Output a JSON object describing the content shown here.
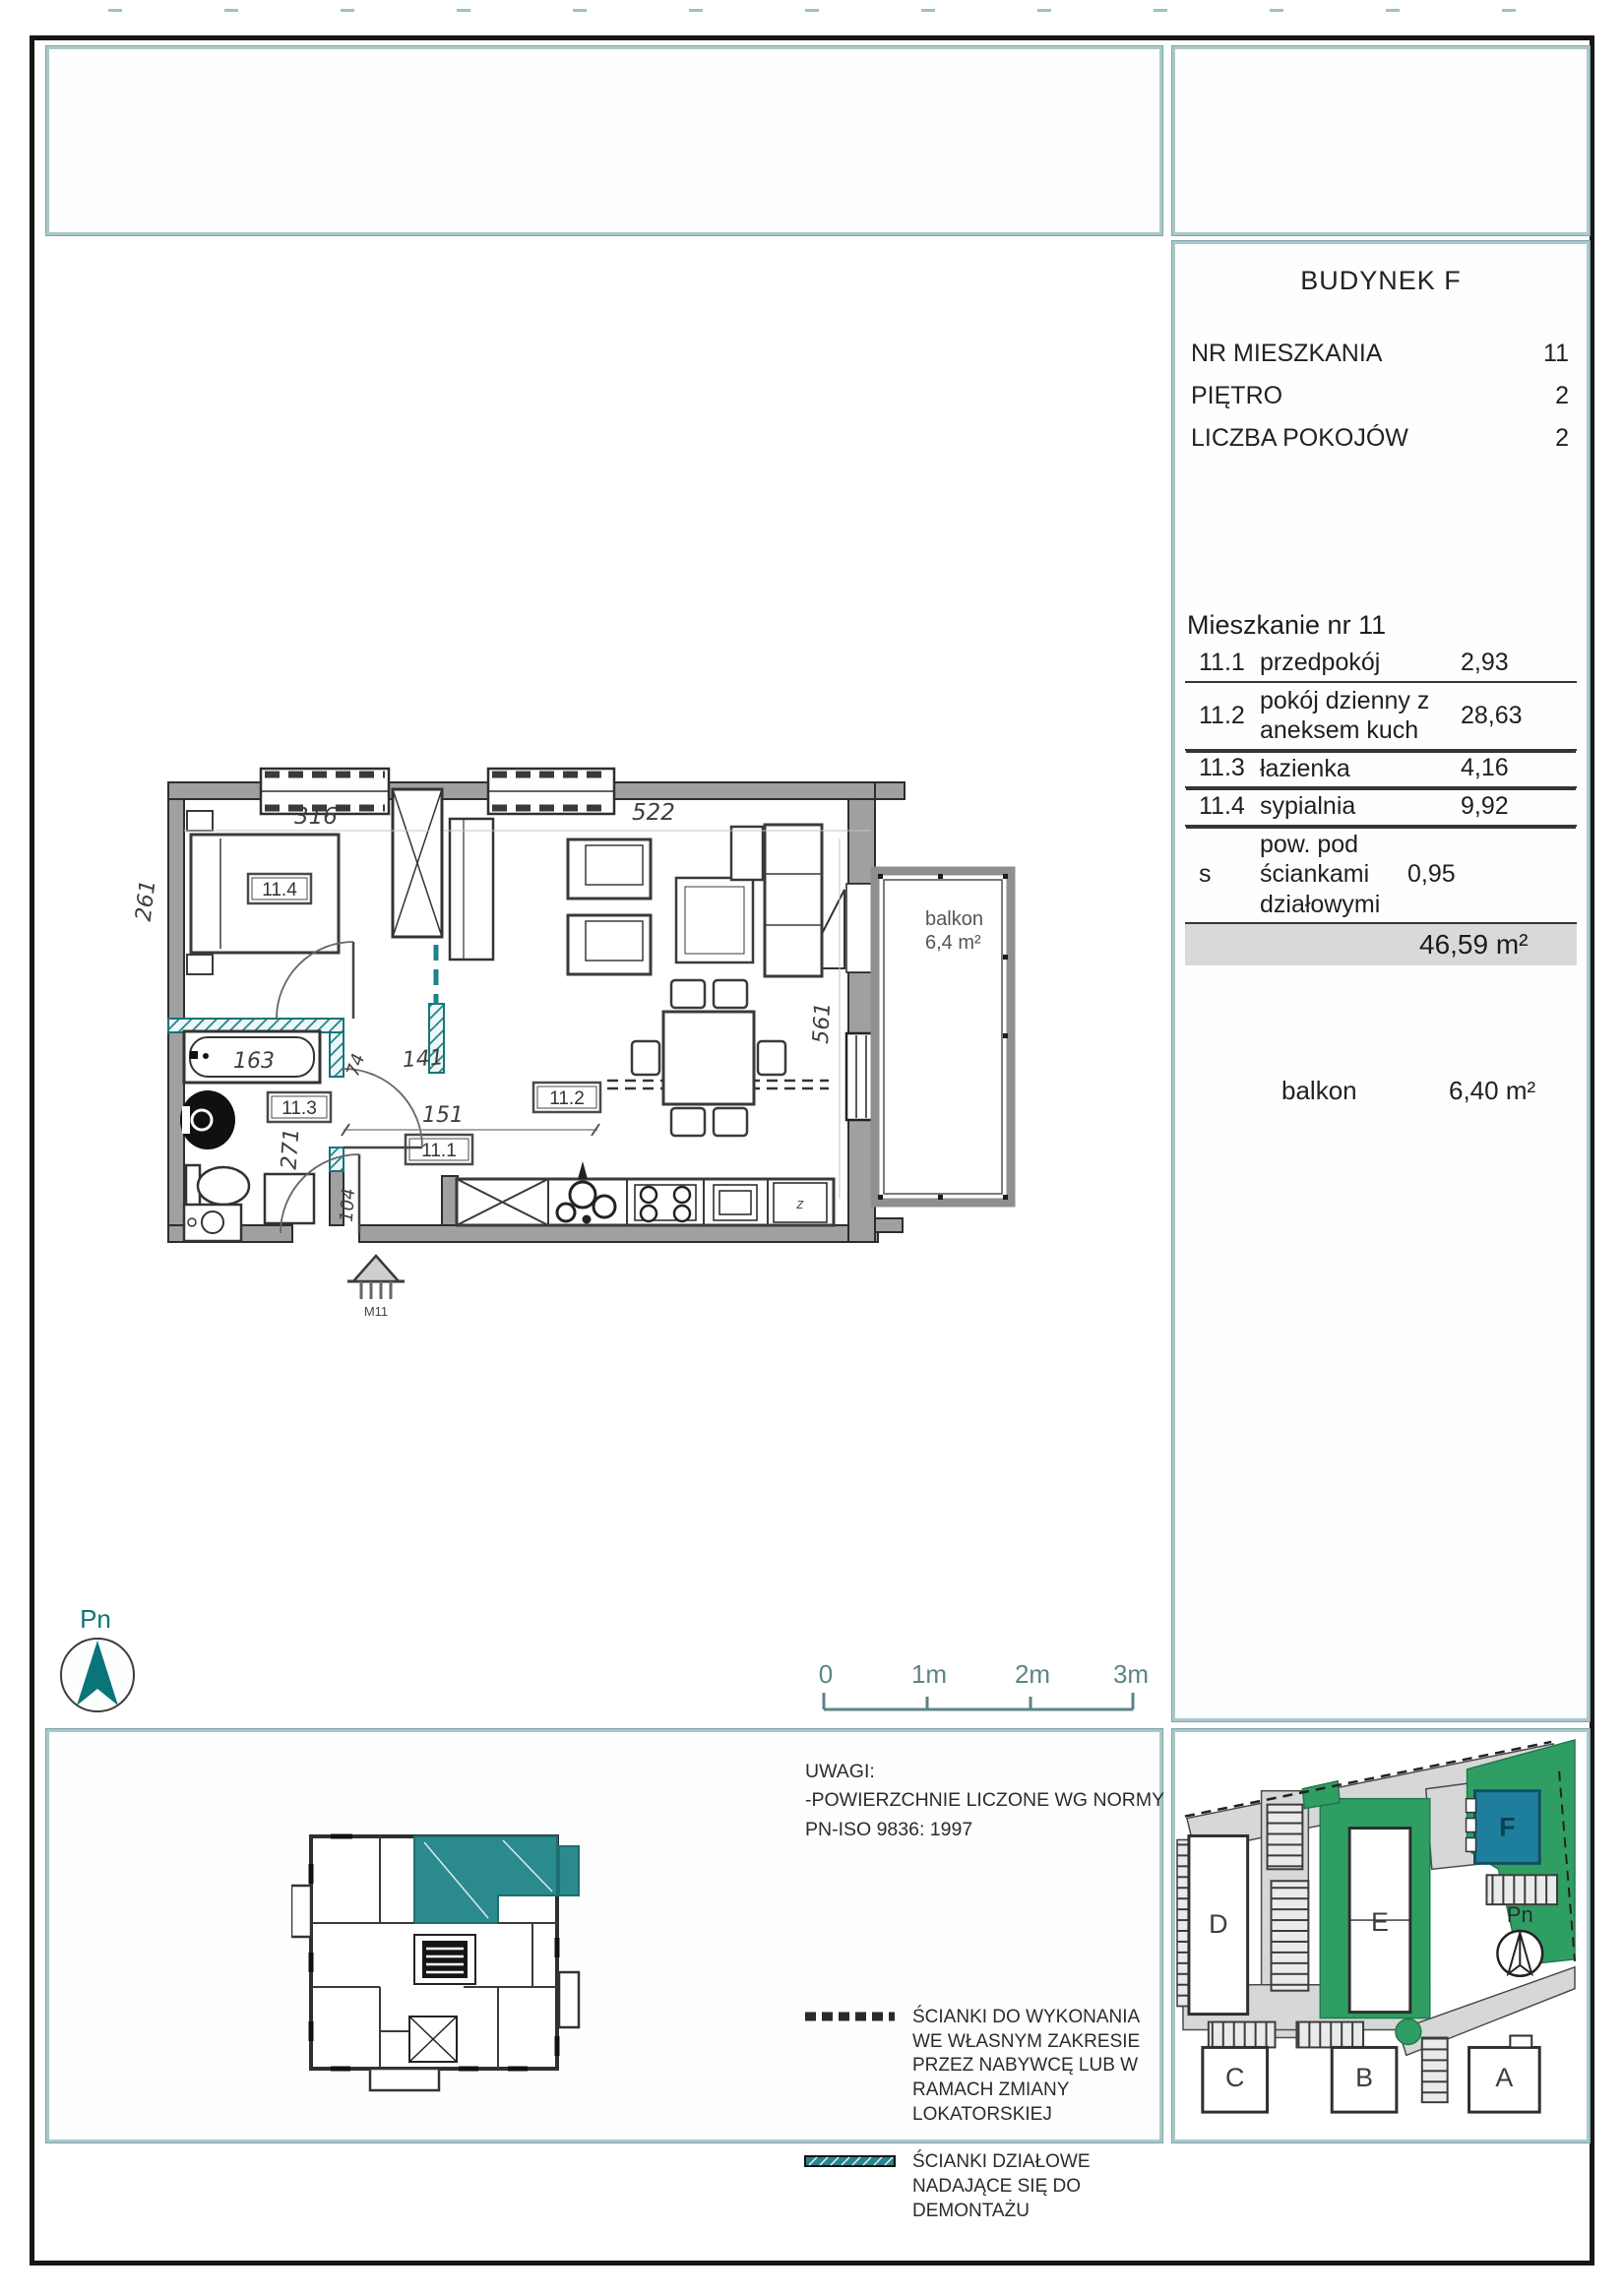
{
  "info_panel": {
    "title": "BUDYNEK F",
    "fields": [
      {
        "label": "NR MIESZKANIA",
        "value": "11"
      },
      {
        "label": "PIĘTRO",
        "value": "2"
      },
      {
        "label": "LICZBA POKOJÓW",
        "value": "2"
      }
    ],
    "apartment_heading": "Mieszkanie nr 11",
    "rooms": [
      {
        "no": "11.1",
        "name": "przedpokój",
        "area": "2,93"
      },
      {
        "no": "11.2",
        "name": "pokój dzienny z aneksem kuch",
        "area": "28,63"
      },
      {
        "no": "11.3",
        "name": "łazienka",
        "area": "4,16"
      },
      {
        "no": "11.4",
        "name": "sypialnia",
        "area": "9,92"
      },
      {
        "no": "s",
        "name": "pow. pod ściankami działowymi",
        "area": "0,95"
      }
    ],
    "total_area": "46,59 m²",
    "balcony_label": "balkon",
    "balcony_area": "6,40 m²"
  },
  "floor_plan": {
    "rooms": {
      "hall": "11.1",
      "living": "11.2",
      "bath": "11.3",
      "bedroom": "11.4"
    },
    "dims": {
      "top_left": "316",
      "top_right": "522",
      "left_side": "261",
      "right_side": "561",
      "bath_tub": "163",
      "hall_a": "74",
      "hall_b": "141",
      "hall_c": "151",
      "bath_height": "271",
      "entry": "104"
    },
    "balcony": {
      "label": "balkon",
      "area": "6,4 m²"
    },
    "entrance_label": "M11",
    "fridge_label": "z",
    "compass_label": "Pn"
  },
  "scale_bar": {
    "t0": "0",
    "t1": "1m",
    "t2": "2m",
    "t3": "3m"
  },
  "notes_panel": {
    "uwagi_line1": "UWAGI:",
    "uwagi_line2": "-POWIERZCHNIE LICZONE WG NORMY",
    "uwagi_line3": "PN-ISO 9836: 1997",
    "legend": [
      {
        "text": "ŚCIANKI DO WYKONANIA WE WŁASNYM ZAKRESIE PRZEZ NABYWCĘ LUB W RAMACH ZMIANY LOKATORSKIEJ"
      },
      {
        "text": "ŚCIANKI DZIAŁOWE NADAJĄCE SIĘ DO DEMONTAŻU"
      }
    ]
  },
  "site_plan": {
    "buildings": {
      "a": "A",
      "b": "B",
      "c": "C",
      "d": "D",
      "e": "E",
      "f": "F"
    },
    "highlighted_building": "F",
    "compass_label": "Pn"
  },
  "colors": {
    "accent_teal": "#0b7478",
    "building_f": "#1e7f9d",
    "lawn_green": "#2f9e63",
    "panel_border": "#abc7c9",
    "total_row_bg": "#d9d9d9"
  }
}
